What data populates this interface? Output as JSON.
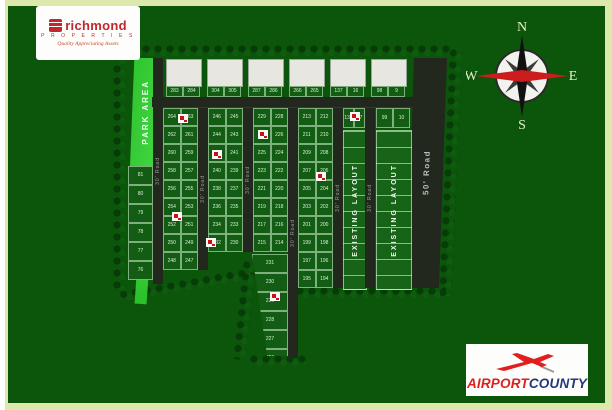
{
  "branding": {
    "richmond": {
      "name": "richmond",
      "subtitle": "P R O P E R T I E S",
      "tagline": "Quality Appreciating Assets"
    },
    "airport": {
      "word1": "AIRPORT",
      "word2": "COUNTY"
    }
  },
  "compass": {
    "n": "N",
    "e": "E",
    "s": "S",
    "w": "W"
  },
  "colors": {
    "background_green": "#0c560c",
    "frame": "#dde9ac",
    "park_green": "#35cf35",
    "road_dark": "#23281f",
    "plot_green": "#135c13",
    "marker_red": "#cc1111",
    "airport_red": "#e01f1f",
    "airport_navy": "#27357a",
    "richmond_red": "#c3272e"
  },
  "plan": {
    "park_label": "PARK AREA",
    "existing_label": "EXISTING LAYOUT",
    "road30": "30' Road",
    "road50": "50' Road",
    "left_col_numbers": [
      81,
      80,
      79,
      78,
      77,
      76
    ],
    "top_pairs": [
      [
        283,
        284
      ],
      [
        304,
        305
      ],
      [
        287,
        286
      ],
      [
        266,
        265
      ],
      [
        137,
        16
      ],
      [
        98,
        9
      ]
    ],
    "strip_pairs": [
      [
        138,
        17
      ],
      [
        99,
        10
      ]
    ],
    "columns": [
      {
        "pairs": [
          [
            264,
            263
          ],
          [
            262,
            261
          ],
          [
            260,
            259
          ],
          [
            258,
            257
          ],
          [
            256,
            255
          ],
          [
            254,
            253
          ],
          [
            252,
            251
          ],
          [
            250,
            249
          ],
          [
            248,
            247
          ]
        ]
      },
      {
        "pairs": [
          [
            246,
            245
          ],
          [
            244,
            243
          ],
          [
            242,
            241
          ],
          [
            240,
            239
          ],
          [
            238,
            237
          ],
          [
            236,
            235
          ],
          [
            234,
            233
          ],
          [
            232,
            230
          ]
        ]
      },
      {
        "pairs": [
          [
            229,
            228
          ],
          [
            227,
            226
          ],
          [
            225,
            224
          ],
          [
            223,
            222
          ],
          [
            221,
            220
          ],
          [
            219,
            218
          ],
          [
            217,
            216
          ],
          [
            215,
            214
          ]
        ]
      },
      {
        "pairs": [
          [
            213,
            212
          ],
          [
            211,
            210
          ],
          [
            209,
            208
          ],
          [
            207,
            206
          ],
          [
            205,
            204
          ],
          [
            203,
            202
          ],
          [
            201,
            200
          ],
          [
            199,
            198
          ],
          [
            197,
            196
          ],
          [
            195,
            194
          ]
        ]
      }
    ],
    "wedge_numbers": [
      231,
      230,
      229,
      228,
      227,
      226
    ],
    "markers": [
      {
        "x": 66,
        "y": 70
      },
      {
        "x": 100,
        "y": 106
      },
      {
        "x": 146,
        "y": 86
      },
      {
        "x": 204,
        "y": 128
      },
      {
        "x": 94,
        "y": 194
      },
      {
        "x": 158,
        "y": 248
      },
      {
        "x": 238,
        "y": 68
      },
      {
        "x": 60,
        "y": 168
      }
    ]
  }
}
